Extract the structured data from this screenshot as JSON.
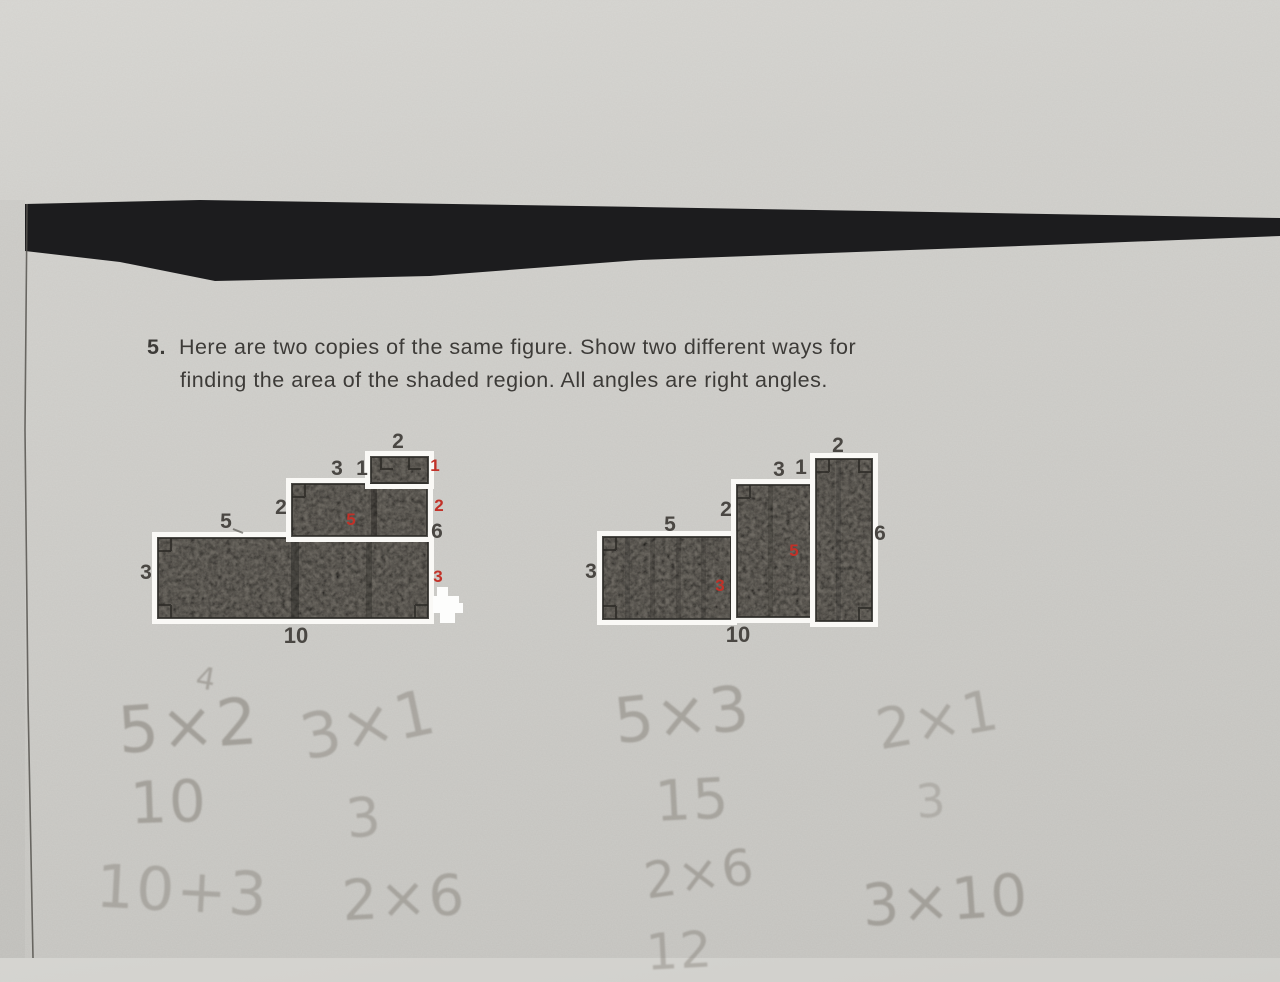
{
  "problem": {
    "number": "5.",
    "line1": "Here are two copies of the same figure. Show two different ways for",
    "line2": "finding the area of the shaded region. All angles are right angles."
  },
  "figure_left": {
    "top_width": "2",
    "mid_top_left": "3",
    "mid_top_right": "1",
    "mid_height": "2",
    "bottom_left_width": "5",
    "bottom_height": "3",
    "total_height": "6",
    "bottom_width": "10",
    "red_top_height": "1",
    "red_mid_height": "2",
    "red_bottom_height": "3",
    "red_mid_width": "5"
  },
  "figure_right": {
    "left_width": "5",
    "step_height": "2",
    "mid_width": "3",
    "offset_height": "1",
    "right_width": "2",
    "left_height": "3",
    "total_height": "6",
    "bottom_width": "10",
    "red_left_height": "3",
    "red_mid_height": "5"
  },
  "pencil_work": {
    "superscript": "4",
    "items": [
      {
        "expr": "5×2",
        "result": "10"
      },
      {
        "expr": "3×1",
        "result": "3"
      },
      {
        "expr": "5×3",
        "result": "15"
      },
      {
        "expr": "2×1",
        "result": "3"
      },
      {
        "expr": "10+3",
        "result": ""
      },
      {
        "expr": "2×6",
        "result": ""
      },
      {
        "expr": "2×6",
        "result": "12"
      },
      {
        "expr": "3×10",
        "result": ""
      }
    ]
  },
  "colors": {
    "paper": "#cac9c5",
    "scan_band": "#1c1c1e",
    "pencil_shade": "#6e6a63",
    "red_annotation": "#c23128",
    "print_ink": "#3d3b38",
    "pencil": "#6f6960"
  }
}
